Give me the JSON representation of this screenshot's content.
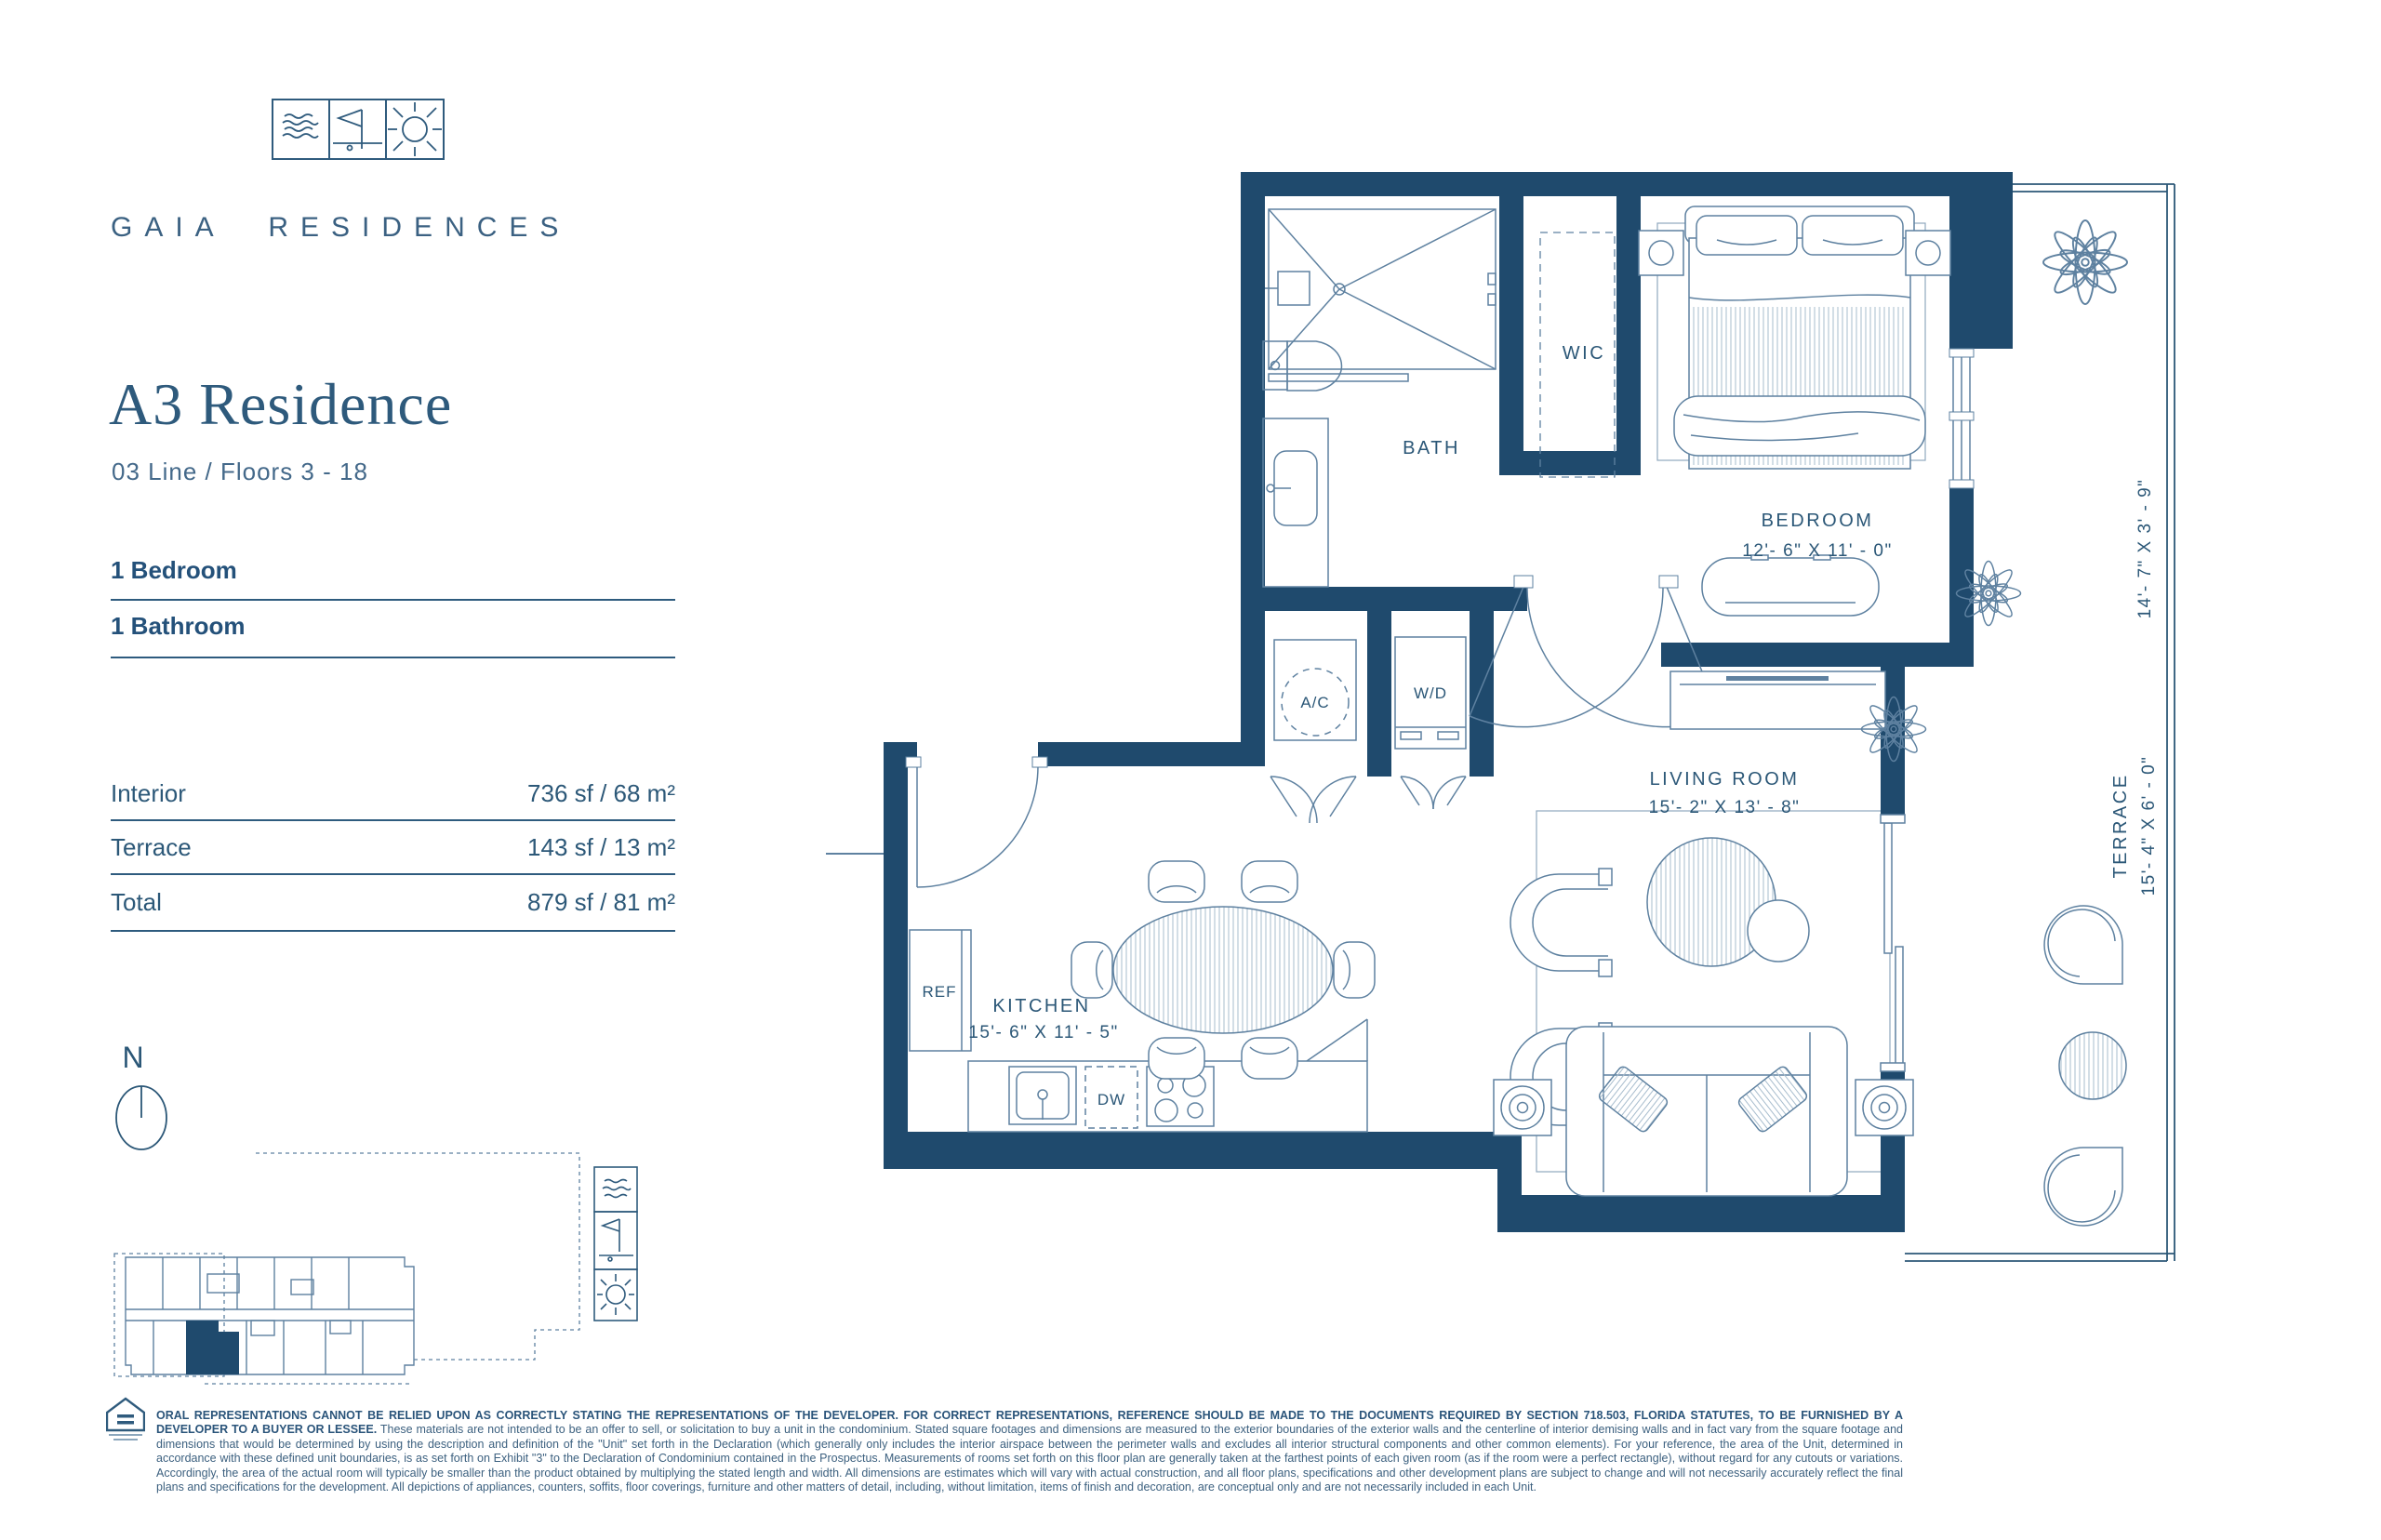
{
  "brand": {
    "name": "GAIA RESIDENCES",
    "logo_icons": [
      "waves-icon",
      "flag-icon",
      "sun-icon"
    ]
  },
  "unit": {
    "title": "A3 Residence",
    "subtitle": "03 Line / Floors 3 - 18",
    "features": [
      "1 Bedroom",
      "1 Bathroom"
    ],
    "areas": [
      {
        "label": "Interior",
        "value": "736 sf / 68 m²"
      },
      {
        "label": "Terrace",
        "value": "143 sf / 13 m²"
      },
      {
        "label": "Total",
        "value": "879 sf / 81 m²"
      }
    ]
  },
  "plan": {
    "bath": "BATH",
    "wic": "WIC",
    "bedroom": {
      "name": "BEDROOM",
      "dims": "12'- 6\" X 11' - 0\""
    },
    "living": {
      "name": "LIVING ROOM",
      "dims": "15'- 2\" X 13' - 8\""
    },
    "kitchen": {
      "name": "KITCHEN",
      "dims": "15'- 6\" X 11' - 5\""
    },
    "terrace": {
      "name": "TERRACE",
      "dims": "15'- 4\" X 6' - 0\""
    },
    "terrace_upper_dims": "14'- 7\" X 3' - 9\"",
    "ac": "A/C",
    "wd": "W/D",
    "ref": "REF",
    "dw": "DW",
    "compass": "N"
  },
  "colors": {
    "wall_navy": "#1F4A6D",
    "ink": "#2B5777",
    "furniture_line": "#5E81A0"
  },
  "disclaimer": {
    "bold": "ORAL REPRESENTATIONS CANNOT BE RELIED UPON AS CORRECTLY STATING THE REPRESENTATIONS OF THE DEVELOPER.  FOR CORRECT REPRESENTATIONS, REFERENCE SHOULD BE MADE TO THE DOCUMENTS REQUIRED BY SECTION 718.503, FLORIDA STATUTES, TO BE FURNISHED BY A DEVELOPER TO A BUYER OR LESSEE.",
    "body": " These materials are not intended to be an offer to sell, or solicitation to buy a unit in the condominium.  Stated square footages and dimensions are measured to the exterior boundaries of the exterior walls and the centerline of interior demising walls and in fact vary from the square footage and dimensions that would be determined by using the description and definition of the \"Unit\" set forth in the Declaration (which generally only includes the interior airspace between the perimeter walls and excludes all interior structural components and other common elements). For your reference, the area of the Unit, determined in accordance with these defined unit boundaries, is as set forth on Exhibit \"3\" to the Declaration of Condominium contained in the Prospectus.  Measurements of rooms set forth on this floor plan are generally taken at the farthest points of each given room (as if the room were a perfect rectangle), without regard for any cutouts or variations. Accordingly, the area of the actual room will typically be smaller than the product obtained by multiplying the stated length and width. All dimensions are estimates which will vary with actual construction, and all floor plans, specifications and other development plans are subject to change and will not necessarily accurately reflect the final plans and specifications for the development. All depictions of appliances, counters, soffits, floor coverings, furniture and other matters of detail, including, without limitation, items of finish and decoration, are conceptual only and are not necessarily included in each Unit."
  }
}
